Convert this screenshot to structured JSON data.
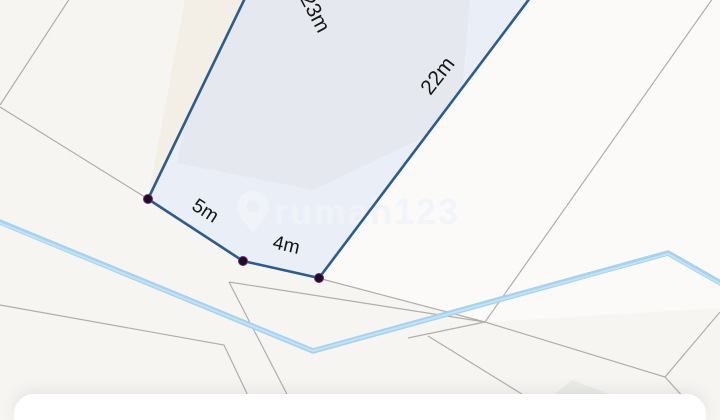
{
  "map": {
    "measurement_labels": [
      {
        "edge": "top-left-edge",
        "text": "23m"
      },
      {
        "edge": "right-edge",
        "text": "22m"
      },
      {
        "edge": "bottom-left-edge",
        "text": "5m"
      },
      {
        "edge": "bottom-edge",
        "text": "4m"
      }
    ],
    "watermark": {
      "text": "rumah123",
      "icon": "location-pin-icon"
    },
    "colors": {
      "background": "#f7f5f2",
      "plot_fill": "#e9eef7",
      "plot_stroke": "#2b5c8f",
      "vertex_dot": "#200c28",
      "vertex_ring": "#6b2d72",
      "river": "#a6d2ee",
      "river_core": "#c3e2f5",
      "parcel_line": "#b1aeaa",
      "adjacent_parcel_beige": "#f3eee6",
      "building_footprint": "#e5e9ef",
      "watermark_tint": "#f0f4f8",
      "bottom_sheet": "#ffffff"
    }
  },
  "bottom_sheet": {}
}
